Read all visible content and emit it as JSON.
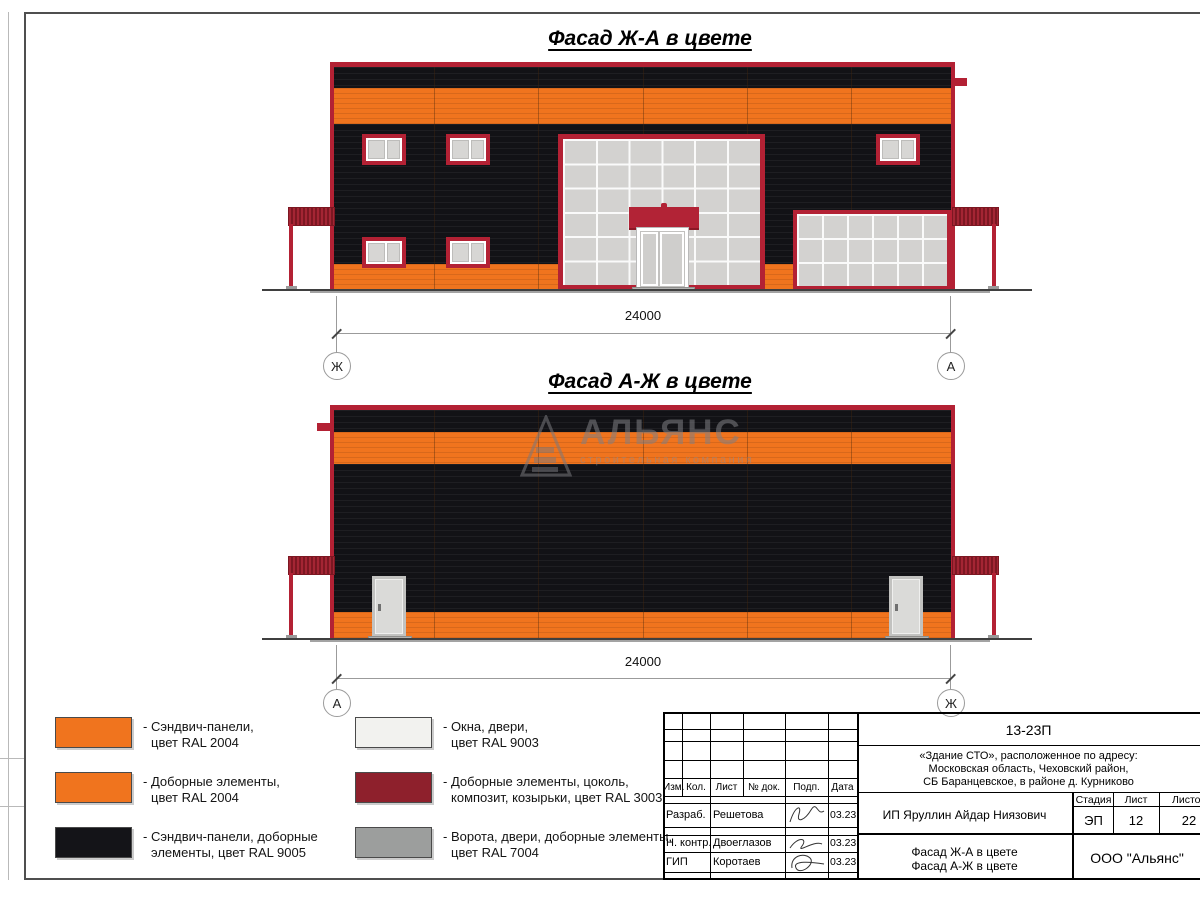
{
  "facade_top": {
    "title": "Фасад Ж-А в цвете",
    "dimension": "24000",
    "axis_left": "Ж",
    "axis_right": "А"
  },
  "facade_bottom": {
    "title": "Фасад А-Ж в цвете",
    "dimension": "24000",
    "axis_left": "А",
    "axis_right": "Ж"
  },
  "watermark": {
    "brand": "АЛЬЯНС",
    "tagline": "строительная компания"
  },
  "legend": {
    "items": [
      {
        "color": "#f0741e",
        "line1": "- Сэндвич-панели,",
        "line2": "цвет RAL 2004"
      },
      {
        "color": "#f0741e",
        "line1": "- Доборные элементы,",
        "line2": "цвет RAL 2004"
      },
      {
        "color": "#141418",
        "line1": "- Сэндвич-панели, доборные",
        "line2": "элементы, цвет RAL 9005"
      },
      {
        "color": "#f2f2ef",
        "line1": "- Окна, двери,",
        "line2": "цвет RAL 9003"
      },
      {
        "color": "#8e202c",
        "line1": "- Доборные элементы, цоколь,",
        "line2": "композит, козырьки, цвет RAL 3003"
      },
      {
        "color": "#9c9e9d",
        "line1": "- Ворота, двери, доборные элементы,",
        "line2": "цвет RAL 7004"
      }
    ]
  },
  "title_block": {
    "doc_number": "13-23П",
    "address1": "«Здание СТО», расположенное по адресу:",
    "address2": "Московская область, Чеховский район,",
    "address3": "СБ Баранцевское, в районе д. Курниково",
    "col_headers": [
      "Изм.",
      "Кол.",
      "Лист",
      "№ док.",
      "Подп.",
      "Дата"
    ],
    "stage_h": [
      "Стадия",
      "Лист",
      "Листов"
    ],
    "stage_v": [
      "ЭП",
      "12",
      "22"
    ],
    "client": "ИП Яруллин Айдар Ниязович",
    "rows": [
      {
        "role": "Разраб.",
        "name": "Решетова",
        "date": "03.23"
      },
      {
        "role": "Н. контр.",
        "name": "Двоеглазов",
        "date": "03.23"
      },
      {
        "role": "ГИП",
        "name": "Коротаев",
        "date": "03.23"
      }
    ],
    "subject1": "Фасад Ж-А в цвете",
    "subject2": "Фасад А-Ж в цвете",
    "company": "ООО \"Альянс\""
  }
}
